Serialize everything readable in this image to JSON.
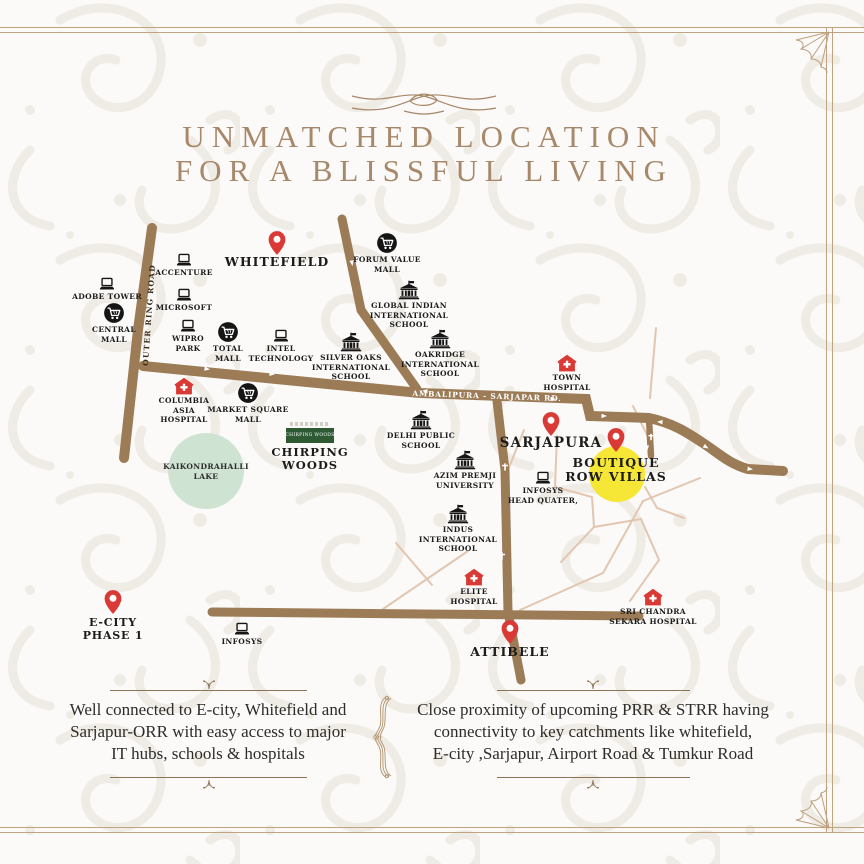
{
  "title": {
    "line1": "UNMATCHED LOCATION",
    "line2": "FOR A BLISSFUL LIVING"
  },
  "map": {
    "road_labels": {
      "outer_ring_road": "OUTER RING ROAD",
      "sarjapur_road": "AMBALIPURA - SARJAPAR RD."
    },
    "landmarks": [
      {
        "id": "adobe-tower",
        "type": "laptop",
        "x": 107,
        "y": 284,
        "label": [
          "ADOBE TOWER"
        ]
      },
      {
        "id": "accenture",
        "type": "laptop",
        "x": 184,
        "y": 260,
        "label": [
          "ACCENTURE"
        ]
      },
      {
        "id": "microsoft",
        "type": "laptop",
        "x": 184,
        "y": 295,
        "label": [
          "MICROSOFT"
        ]
      },
      {
        "id": "wipro-park",
        "type": "laptop",
        "x": 188,
        "y": 326,
        "label": [
          "WIPRO",
          "PARK"
        ]
      },
      {
        "id": "intel-technology",
        "type": "laptop",
        "x": 281,
        "y": 336,
        "label": [
          "INTEL",
          "TECHNOLOGY"
        ]
      },
      {
        "id": "infosys",
        "type": "laptop",
        "x": 242,
        "y": 629,
        "label": [
          "INFOSYS"
        ]
      },
      {
        "id": "infosys-head-quater",
        "type": "laptop",
        "x": 543,
        "y": 478,
        "label": [
          "INFOSYS",
          "HEAD QUATER,"
        ]
      },
      {
        "id": "central-mall",
        "type": "mall",
        "x": 114,
        "y": 313,
        "label": [
          "CENTRAL",
          "MALL"
        ]
      },
      {
        "id": "total-mall",
        "type": "mall",
        "x": 228,
        "y": 332,
        "label": [
          "TOTAL",
          "MALL"
        ]
      },
      {
        "id": "forum-value-mall",
        "type": "mall",
        "x": 387,
        "y": 243,
        "label": [
          "FORUM VALUE",
          "MALL"
        ]
      },
      {
        "id": "market-square-mall",
        "type": "mall",
        "x": 248,
        "y": 393,
        "label": [
          "MARKET SQUARE",
          "MALL"
        ]
      },
      {
        "id": "global-indian-international-school",
        "type": "school",
        "x": 409,
        "y": 290,
        "label": [
          "GLOBAL INDIAN",
          "INTERNATIONAL",
          "SCHOOL"
        ]
      },
      {
        "id": "silver-oaks-international-school",
        "type": "school",
        "x": 351,
        "y": 342,
        "label": [
          "SILVER OAKS",
          "INTERNATIONAL",
          "SCHOOL"
        ]
      },
      {
        "id": "oakridge-international-school",
        "type": "school",
        "x": 440,
        "y": 339,
        "label": [
          "OAKRIDGE",
          "INTERNATIONAL",
          "SCHOOL"
        ]
      },
      {
        "id": "delhi-public-school",
        "type": "school",
        "x": 421,
        "y": 420,
        "label": [
          "DELHI PUBLIC",
          "SCHOOL"
        ]
      },
      {
        "id": "azim-premji-university",
        "type": "school",
        "x": 465,
        "y": 460,
        "label": [
          "AZIM PREMJI",
          "UNIVERSITY"
        ]
      },
      {
        "id": "indus-international-school",
        "type": "school",
        "x": 458,
        "y": 514,
        "label": [
          "INDUS",
          "INTERNATIONAL",
          "SCHOOL"
        ]
      },
      {
        "id": "columbia-asia-hospital",
        "type": "hospital",
        "x": 184,
        "y": 386,
        "label": [
          "COLUMBIA",
          "ASIA",
          "HOSPITAL"
        ]
      },
      {
        "id": "town-hospital",
        "type": "hospital",
        "x": 567,
        "y": 363,
        "label": [
          "TOWN",
          "HOSPITAL"
        ]
      },
      {
        "id": "elite-hospital",
        "type": "hospital",
        "x": 474,
        "y": 577,
        "label": [
          "ELITE",
          "HOSPITAL"
        ]
      },
      {
        "id": "sri-chandra-sekara-hospital",
        "type": "hospital",
        "x": 653,
        "y": 597,
        "label": [
          "SRI CHANDRA",
          "SEKARA HOSPITAL"
        ]
      },
      {
        "id": "whitefield",
        "type": "pin",
        "x": 277,
        "y": 243,
        "label": [
          "WHITEFIELD"
        ],
        "size": "l",
        "ldy": 12
      },
      {
        "id": "sarjapura",
        "type": "pin",
        "x": 551,
        "y": 424,
        "label": [
          "SARJAPURA"
        ],
        "size": "xl",
        "ldy": 12
      },
      {
        "id": "e-city-phase-1",
        "type": "pin",
        "x": 113,
        "y": 602,
        "label": [
          "E-CITY",
          "PHASE 1"
        ],
        "size": "m",
        "ldy": 15
      },
      {
        "id": "attibele",
        "type": "pin",
        "x": 510,
        "y": 632,
        "label": [
          "ATTIBELE"
        ],
        "size": "l",
        "ldy": 13
      },
      {
        "id": "boutique-row-villas",
        "type": "pin",
        "x": 616,
        "y": 440,
        "label": [
          "BOUTIQUE",
          "ROW VILLAS"
        ],
        "size": "l",
        "ldy": 16,
        "highlight": {
          "dx": 1,
          "dy": 34,
          "r": 28
        }
      },
      {
        "id": "kaikondrahalli-lake",
        "type": "lake",
        "x": 206,
        "y": 471,
        "label": [
          "KAIKONDRAHALLI",
          "LAKE"
        ],
        "r": 38
      },
      {
        "id": "chirping-woods",
        "type": "logo",
        "x": 310,
        "y": 436,
        "label": [
          "CHIRPING",
          "WOODS"
        ]
      }
    ]
  },
  "footer": {
    "left_lines": [
      "Well connected to E-city, Whitefield and",
      "Sarjapur-ORR with easy access to major",
      "IT hubs, schools & hospitals"
    ],
    "right_lines": [
      "Close proximity of upcoming PRR & STRR having",
      "connectivity to key catchments like whitefield,",
      "E-city ,Sarjapur, Airport Road & Tumkur Road"
    ]
  },
  "colors": {
    "accent": "#a8886a",
    "road": "#9c7c56",
    "road_minor": "#e2c6b0",
    "pin_red": "#d93a35",
    "highlight_yellow": "#f6e636",
    "lake_green": "#cfe3d3",
    "logo_green": "#2d5a33",
    "text_dark": "#1b1b1b"
  }
}
